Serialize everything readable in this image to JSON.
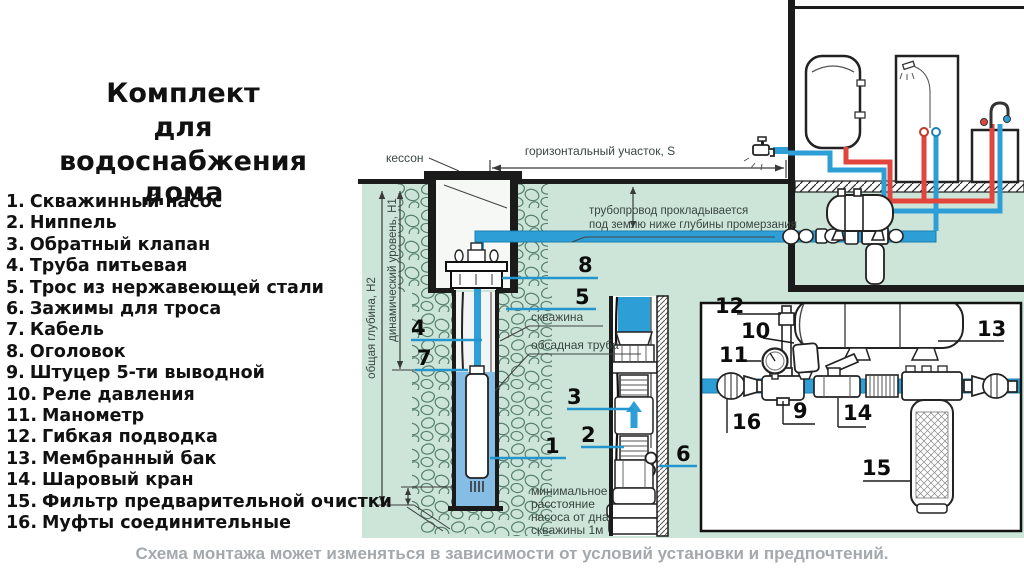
{
  "title": {
    "line1": "Комплект",
    "line2": "для",
    "line3": "водоснабжения дома"
  },
  "legend": {
    "items": [
      {
        "n": "1.",
        "t": "Скважинный насос"
      },
      {
        "n": "2.",
        "t": "Ниппель"
      },
      {
        "n": "3.",
        "t": "Обратный клапан"
      },
      {
        "n": "4.",
        "t": "Труба питьевая"
      },
      {
        "n": "5.",
        "t": "Трос из нержавеющей стали"
      },
      {
        "n": "6.",
        "t": "Зажимы для троса"
      },
      {
        "n": "7.",
        "t": "Кабель"
      },
      {
        "n": "8.",
        "t": "Оголовок"
      },
      {
        "n": "9.",
        "t": "Штуцер 5-ти выводной"
      },
      {
        "n": "10.",
        "t": "Реле давления"
      },
      {
        "n": "11.",
        "t": "Манометр"
      },
      {
        "n": "12.",
        "t": "Гибкая подводка"
      },
      {
        "n": "13.",
        "t": "Мембранный бак"
      },
      {
        "n": "14.",
        "t": "Шаровый кран"
      },
      {
        "n": "15.",
        "t": "Фильтр предварительной очистки"
      },
      {
        "n": "16.",
        "t": "Муфты соединительные"
      }
    ]
  },
  "diagram": {
    "labels": {
      "kesson": "кессон",
      "s_dim": "горизонтальный участок, S",
      "freeze1": "трубопровод прокладывается",
      "freeze2": "под землю ниже глубины промерзания",
      "well": "скважина",
      "casing": "обсадная труба",
      "h2": "общая глубина, Н2",
      "h1": "динамический уровень, Н1",
      "min1": "минимальное",
      "min2": "расстояние",
      "min3": "насоса от дна",
      "min4": "скважины 1м"
    },
    "callouts": {
      "c1": "1",
      "c2": "2",
      "c3": "3",
      "c4": "4",
      "c5": "5",
      "c6": "6",
      "c7": "7",
      "c8": "8",
      "c9": "9",
      "c10": "10",
      "c11": "11",
      "c12": "12",
      "c13": "13",
      "c14": "14",
      "c15": "15",
      "c16": "16"
    },
    "colors": {
      "ground": "#cde5d8",
      "pipe_cold": "#2d9fd6",
      "pipe_hot": "#e2453c",
      "leader": "#2596cd"
    }
  },
  "footer": {
    "note": "Схема монтажа может изменяться в зависимости от условий установки и предпочтений."
  }
}
